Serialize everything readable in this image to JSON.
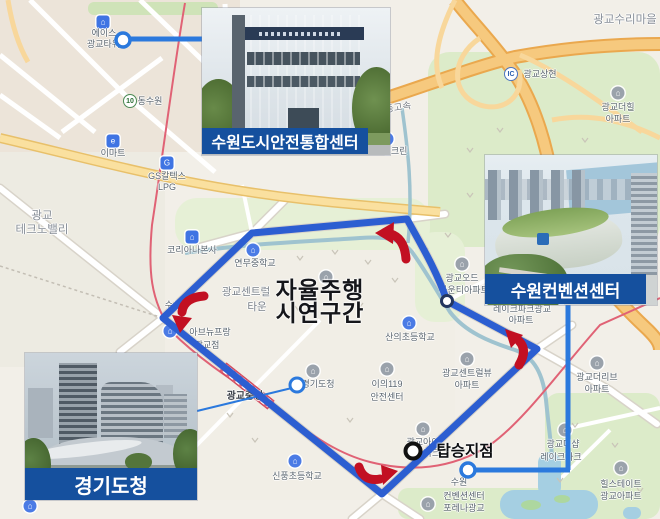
{
  "figure": {
    "type": "route-map-figure",
    "overlay": {
      "line1": "자율주행",
      "line2": "시연구간"
    },
    "boarding_label": "탑승지점"
  },
  "callouts": [
    {
      "id": "safety-center",
      "label": "수원도시안전통합센터"
    },
    {
      "id": "convention-center",
      "label": "수원컨벤션센터"
    },
    {
      "id": "provincial-office",
      "label": "경기도청"
    }
  ],
  "map": {
    "pois": [
      {
        "name": "poi-ace-gwanggyo-tower",
        "icon": {
          "style": "blue-square",
          "glyph": "⌂",
          "x": 103,
          "y": 22
        },
        "lines": [
          {
            "t": "에이스",
            "x": 104,
            "y": 33
          },
          {
            "t": "광교타워1",
            "x": 106,
            "y": 44
          }
        ]
      },
      {
        "name": "poi-dongsuwon-ic",
        "icon": {
          "style": "badge",
          "glyph": "10",
          "x": 130,
          "y": 101
        },
        "lines": [
          {
            "t": "동수원",
            "x": 150,
            "y": 101
          }
        ]
      },
      {
        "name": "poi-emart",
        "icon": {
          "style": "blue-square",
          "glyph": "e",
          "x": 113,
          "y": 141
        },
        "lines": [
          {
            "t": "이마트",
            "x": 113,
            "y": 153
          }
        ]
      },
      {
        "name": "poi-gs-caltex",
        "icon": {
          "style": "blue-square",
          "glyph": "G",
          "x": 167,
          "y": 163
        },
        "lines": [
          {
            "t": "GS칼텍스",
            "x": 167,
            "y": 176
          },
          {
            "t": "LPG",
            "x": 167,
            "y": 187
          }
        ]
      },
      {
        "name": "poi-sk-encrean",
        "icon": {
          "style": "blue-circle",
          "glyph": "S",
          "x": 387,
          "y": 139
        },
        "lines": [
          {
            "t": "SK엔크린",
            "x": 389,
            "y": 151
          }
        ]
      },
      {
        "name": "road-yeongdong-expressway",
        "lines": [
          {
            "t": "영동고속",
            "x": 394,
            "y": 109
          }
        ],
        "rotate": -9,
        "size": 9.5,
        "color": "#767b83"
      },
      {
        "name": "area-gwanggyo-suri-village",
        "lines": [
          {
            "t": "광교수리마을",
            "x": 625,
            "y": 20
          }
        ],
        "size": 11.5,
        "color": "#878e97"
      },
      {
        "name": "poi-gwanggyo-sanghyeon-ic",
        "icon": {
          "style": "badge-blue",
          "glyph": "IC",
          "x": 511,
          "y": 74
        },
        "lines": [
          {
            "t": "광교상현",
            "x": 540,
            "y": 74
          }
        ]
      },
      {
        "name": "poi-gwanggyo-the-hill-apt",
        "icon": {
          "style": "gray-circle",
          "glyph": "⌂",
          "x": 618,
          "y": 93
        },
        "lines": [
          {
            "t": "광교더힐",
            "x": 618,
            "y": 107
          },
          {
            "t": "아파트",
            "x": 618,
            "y": 119
          }
        ]
      },
      {
        "name": "area-gwanggyo-technovalley",
        "lines": [
          {
            "t": "광교",
            "x": 42,
            "y": 216
          },
          {
            "t": "테크노밸리",
            "x": 42,
            "y": 230
          }
        ],
        "size": 11.5,
        "color": "#878e97"
      },
      {
        "name": "poi-coreana-hq",
        "icon": {
          "style": "blue-square",
          "glyph": "⌂",
          "x": 192,
          "y": 237
        },
        "lines": [
          {
            "t": "코리아나본사",
            "x": 192,
            "y": 250
          }
        ]
      },
      {
        "name": "poi-yeonmu-middle-school",
        "icon": {
          "style": "blue-circle",
          "glyph": "⌂",
          "x": 253,
          "y": 250
        },
        "lines": [
          {
            "t": "연무중학교",
            "x": 255,
            "y": 263
          }
        ]
      },
      {
        "name": "area-gwanggyo-central-town",
        "lines": [
          {
            "t": "광교센트럴",
            "x": 246,
            "y": 292
          },
          {
            "t": "타운",
            "x": 257,
            "y": 307
          }
        ],
        "size": 10.5,
        "color": "#7a818a"
      },
      {
        "name": "poi-susan",
        "lines": [
          {
            "t": "수산",
            "x": 173,
            "y": 305
          }
        ]
      },
      {
        "name": "poi-avenue-france",
        "icon": {
          "style": "blue-circle",
          "glyph": "⌂",
          "x": 170,
          "y": 331
        },
        "lines": [
          {
            "t": "아브뉴프랑",
            "x": 210,
            "y": 332
          },
          {
            "t": "광교점",
            "x": 207,
            "y": 345
          }
        ]
      },
      {
        "name": "poi-sanui-elementary",
        "icon": {
          "style": "blue-circle",
          "glyph": "⌂",
          "x": 409,
          "y": 323
        },
        "lines": [
          {
            "t": "산의초등학교",
            "x": 410,
            "y": 337
          }
        ]
      },
      {
        "name": "poi-gwanggyo-ode-county-apt",
        "icon": {
          "style": "gray-circle",
          "glyph": "⌂",
          "x": 462,
          "y": 264
        },
        "lines": [
          {
            "t": "광교오드",
            "x": 462,
            "y": 278
          },
          {
            "t": "카운티아파트",
            "x": 464,
            "y": 290
          }
        ]
      },
      {
        "name": "poi-lakepark-gwanggyo-apt",
        "lines": [
          {
            "t": "레이크파크광교",
            "x": 522,
            "y": 309
          },
          {
            "t": "아파트",
            "x": 521,
            "y": 320
          }
        ]
      },
      {
        "name": "poi-gwanggyo-centralview-apt",
        "icon": {
          "style": "gray-circle",
          "glyph": "⌂",
          "x": 467,
          "y": 359
        },
        "lines": [
          {
            "t": "광교센트럴뷰",
            "x": 467,
            "y": 373
          },
          {
            "t": "아파트",
            "x": 467,
            "y": 385
          }
        ]
      },
      {
        "name": "poi-gwanggyo-the-live-apt",
        "icon": {
          "style": "gray-circle",
          "glyph": "⌂",
          "x": 597,
          "y": 363
        },
        "lines": [
          {
            "t": "광교더리브",
            "x": 597,
            "y": 377
          },
          {
            "t": "아파트",
            "x": 597,
            "y": 389
          }
        ]
      },
      {
        "name": "poi-iui-119-center",
        "icon": {
          "style": "gray-circle",
          "glyph": "⌂",
          "x": 387,
          "y": 369
        },
        "lines": [
          {
            "t": "이의119",
            "x": 387,
            "y": 384
          },
          {
            "t": "안전센터",
            "x": 387,
            "y": 397
          }
        ]
      },
      {
        "name": "poi-gwanggyo-ipark",
        "icon": {
          "style": "gray-circle",
          "glyph": "⌂",
          "x": 423,
          "y": 429
        },
        "lines": [
          {
            "t": "광교아이",
            "x": 423,
            "y": 442
          },
          {
            "t": "파크",
            "x": 432,
            "y": 453
          }
        ]
      },
      {
        "name": "station-gwanggyo-jungang",
        "lines": [
          {
            "t": "광교중앙",
            "x": 245,
            "y": 397
          }
        ],
        "size": 10,
        "color": "#3c4149",
        "bold": true
      },
      {
        "name": "poi-sinpung-elementary",
        "icon": {
          "style": "blue-circle",
          "glyph": "⌂",
          "x": 295,
          "y": 461
        },
        "lines": [
          {
            "t": "신풍초등학교",
            "x": 297,
            "y": 476
          }
        ]
      },
      {
        "name": "poi-gyeonggi-office-map",
        "icon": {
          "style": "gray-circle",
          "glyph": "⌂",
          "x": 313,
          "y": 371
        },
        "lines": [
          {
            "t": "경기도청",
            "x": 318,
            "y": 384
          }
        ]
      },
      {
        "name": "poi-suwon-convention-map",
        "lines": [
          {
            "t": "수원",
            "x": 459,
            "y": 482
          },
          {
            "t": "컨벤션센터",
            "x": 464,
            "y": 496
          }
        ]
      },
      {
        "name": "poi-forena-gwanggyo",
        "icon": {
          "style": "gray-circle",
          "glyph": "⌂",
          "x": 428,
          "y": 504
        },
        "lines": [
          {
            "t": "포레나광교",
            "x": 464,
            "y": 508
          }
        ]
      },
      {
        "name": "poi-hillstate-gwanggyo-apt",
        "icon": {
          "style": "gray-circle",
          "glyph": "⌂",
          "x": 621,
          "y": 468
        },
        "lines": [
          {
            "t": "힐스테이트",
            "x": 621,
            "y": 484
          },
          {
            "t": "광교아파트",
            "x": 621,
            "y": 496
          }
        ]
      },
      {
        "name": "poi-gwanggyo-the-sharp-lakepark",
        "icon": {
          "style": "gray-circle",
          "glyph": "⌂",
          "x": 565,
          "y": 430
        },
        "lines": [
          {
            "t": "광교더샵",
            "x": 563,
            "y": 444
          },
          {
            "t": "레이크파크",
            "x": 561,
            "y": 457
          }
        ]
      },
      {
        "name": "poi-hidden-building",
        "icon": {
          "style": "gray-circle",
          "glyph": "⌂",
          "x": 326,
          "y": 277
        },
        "lines": []
      },
      {
        "name": "poi-corner-icon",
        "icon": {
          "style": "blue-circle",
          "glyph": "⌂",
          "x": 30,
          "y": 506
        },
        "lines": []
      }
    ]
  },
  "colors": {
    "route_blue": "#2c5ed1",
    "leader_blue": "#2b79dd",
    "arrow_red": "#c21022",
    "callout_bg": "#15509e",
    "highway_orange": "#f6c97e",
    "railway_red": "#e06275",
    "water": "#a5cfe2",
    "park_green": "#dcebc9",
    "border_navy": "#1e3a68"
  }
}
